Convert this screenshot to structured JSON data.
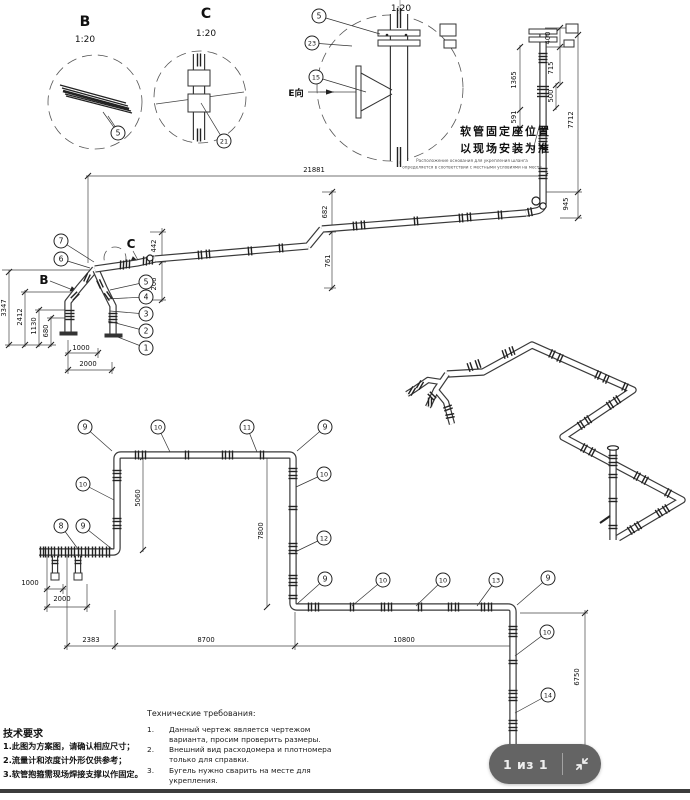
{
  "viewer": {
    "page_indicator": "1 из 1"
  },
  "colors": {
    "overlay_bg": "#646464",
    "bottom_bar": "#3c3c3c",
    "line": "#3a3a3a"
  },
  "details": {
    "b": {
      "title": "B",
      "scale": "1:20"
    },
    "c": {
      "title": "C",
      "scale": "1:20"
    },
    "e": {
      "scale": "1:20"
    }
  },
  "marks": {
    "b": "B",
    "c": "C",
    "e_dir": "E向"
  },
  "annot": {
    "cn_line1": "软管固定座位置",
    "cn_line2": "以现场安装为准",
    "ru_line1": "Расположение основания для укрепления шланга",
    "ru_line2": "определяется в соответствии с местными условиями на месте"
  },
  "tech_requirements_ru": {
    "title": "Технические требования:",
    "items": [
      {
        "num": "1.",
        "text": "Данный чертеж является чертежом варианта, просим проверить размеры."
      },
      {
        "num": "2.",
        "text": "Внешний вид расходомера и плотномера только для справки."
      },
      {
        "num": "3.",
        "text": "Бугель нужно сварить на месте для укрепления."
      }
    ]
  },
  "tech_requirements_cn": {
    "title": "技术要求",
    "items": [
      "1.此图为方案图，请确认相应尺寸；",
      "2.流量计和浓度计外形仅供参考；",
      "3.软管抱箍需现场焊接支撑以作固定。"
    ]
  },
  "dimensions": [
    {
      "t": "21881",
      "x": 314,
      "y": 172,
      "r": 0
    },
    {
      "t": "400",
      "x": 550,
      "y": 38,
      "r": 1
    },
    {
      "t": "715",
      "x": 553,
      "y": 68,
      "r": 1
    },
    {
      "t": "1365",
      "x": 516,
      "y": 80,
      "r": 1
    },
    {
      "t": "500",
      "x": 553,
      "y": 96,
      "r": 1
    },
    {
      "t": "591",
      "x": 516,
      "y": 117,
      "r": 1
    },
    {
      "t": "7712",
      "x": 573,
      "y": 120,
      "r": 1
    },
    {
      "t": "945",
      "x": 568,
      "y": 204,
      "r": 1
    },
    {
      "t": "682",
      "x": 327,
      "y": 212,
      "r": 1
    },
    {
      "t": "761",
      "x": 330,
      "y": 261,
      "r": 1
    },
    {
      "t": "442",
      "x": 156,
      "y": 246,
      "r": 1
    },
    {
      "t": "206",
      "x": 156,
      "y": 284,
      "r": 1
    },
    {
      "t": "3347",
      "x": 6,
      "y": 308,
      "r": 1
    },
    {
      "t": "2412",
      "x": 22,
      "y": 317,
      "r": 1
    },
    {
      "t": "1130",
      "x": 36,
      "y": 326,
      "r": 1
    },
    {
      "t": "680",
      "x": 48,
      "y": 331,
      "r": 1
    },
    {
      "t": "1000",
      "x": 81,
      "y": 350,
      "r": 0
    },
    {
      "t": "2000",
      "x": 88,
      "y": 366,
      "r": 0
    },
    {
      "t": "5060",
      "x": 140,
      "y": 498,
      "r": 1
    },
    {
      "t": "7800",
      "x": 263,
      "y": 531,
      "r": 1
    },
    {
      "t": "1000",
      "x": 30,
      "y": 585,
      "r": 0
    },
    {
      "t": "2000",
      "x": 62,
      "y": 601,
      "r": 0
    },
    {
      "t": "2383",
      "x": 91,
      "y": 642,
      "r": 0
    },
    {
      "t": "8700",
      "x": 206,
      "y": 642,
      "r": 0
    },
    {
      "t": "10800",
      "x": 404,
      "y": 642,
      "r": 0
    },
    {
      "t": "6750",
      "x": 579,
      "y": 677,
      "r": 1
    }
  ],
  "callouts": [
    {
      "label": "5",
      "x": 118,
      "y": 133,
      "lx": 103,
      "ly": 112
    },
    {
      "label": "21",
      "x": 224,
      "y": 141,
      "lx": 201,
      "ly": 103
    },
    {
      "label": "5",
      "x": 319,
      "y": 16,
      "lx": 380,
      "ly": 34
    },
    {
      "label": "23",
      "x": 312,
      "y": 43,
      "lx": 352,
      "ly": 46
    },
    {
      "label": "15",
      "x": 316,
      "y": 77,
      "lx": 366,
      "ly": 92
    },
    {
      "label": "7",
      "x": 61,
      "y": 241,
      "lx": 94,
      "ly": 262
    },
    {
      "label": "6",
      "x": 61,
      "y": 259,
      "lx": 90,
      "ly": 268
    },
    {
      "label": "5",
      "x": 146,
      "y": 282,
      "lx": 110,
      "ly": 290
    },
    {
      "label": "4",
      "x": 146,
      "y": 297,
      "lx": 106,
      "ly": 299
    },
    {
      "label": "3",
      "x": 146,
      "y": 314,
      "lx": 110,
      "ly": 311
    },
    {
      "label": "2",
      "x": 146,
      "y": 331,
      "lx": 108,
      "ly": 321
    },
    {
      "label": "1",
      "x": 146,
      "y": 348,
      "lx": 110,
      "ly": 334
    },
    {
      "label": "9",
      "x": 85,
      "y": 427,
      "lx": 112,
      "ly": 451
    },
    {
      "label": "10",
      "x": 158,
      "y": 427,
      "lx": 170,
      "ly": 452
    },
    {
      "label": "11",
      "x": 247,
      "y": 427,
      "lx": 257,
      "ly": 452
    },
    {
      "label": "9",
      "x": 325,
      "y": 427,
      "lx": 297,
      "ly": 451
    },
    {
      "label": "10",
      "x": 83,
      "y": 484,
      "lx": 114,
      "ly": 500
    },
    {
      "label": "10",
      "x": 324,
      "y": 474,
      "lx": 296,
      "ly": 487
    },
    {
      "label": "8",
      "x": 61,
      "y": 526,
      "lx": 78,
      "ly": 549
    },
    {
      "label": "9",
      "x": 83,
      "y": 526,
      "lx": 112,
      "ly": 549
    },
    {
      "label": "12",
      "x": 324,
      "y": 538,
      "lx": 295,
      "ly": 552
    },
    {
      "label": "9",
      "x": 325,
      "y": 579,
      "lx": 297,
      "ly": 604
    },
    {
      "label": "10",
      "x": 383,
      "y": 580,
      "lx": 352,
      "ly": 606
    },
    {
      "label": "10",
      "x": 443,
      "y": 580,
      "lx": 416,
      "ly": 606
    },
    {
      "label": "13",
      "x": 496,
      "y": 580,
      "lx": 477,
      "ly": 606
    },
    {
      "label": "9",
      "x": 548,
      "y": 578,
      "lx": 517,
      "ly": 605
    },
    {
      "label": "10",
      "x": 547,
      "y": 632,
      "lx": 515,
      "ly": 656
    },
    {
      "label": "14",
      "x": 548,
      "y": 695,
      "lx": 515,
      "ly": 713
    }
  ]
}
